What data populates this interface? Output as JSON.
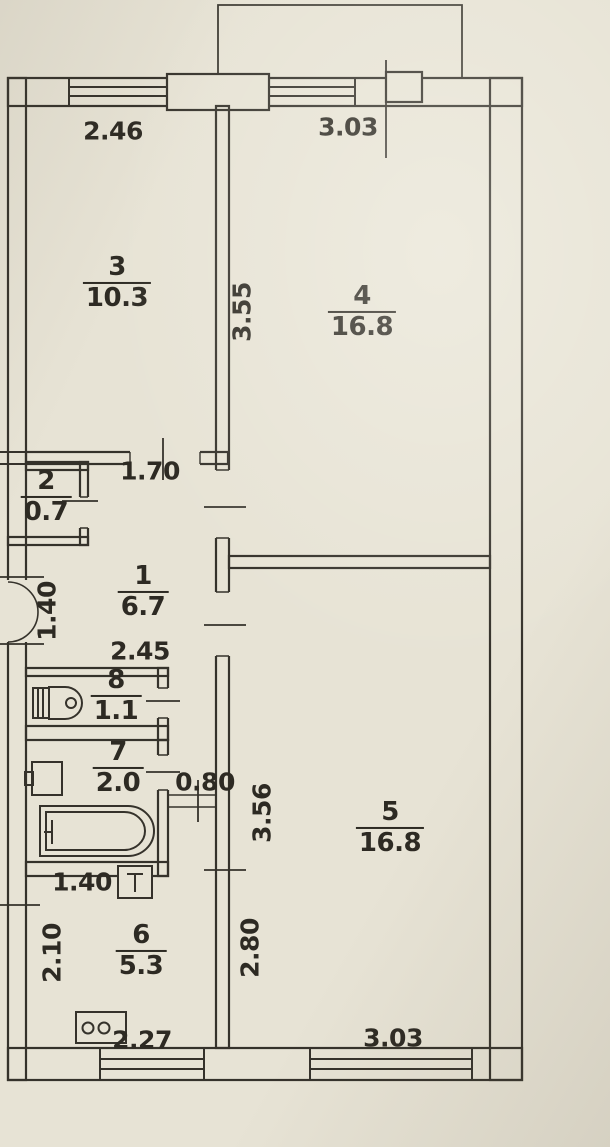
{
  "plan": {
    "title": "apartment-floor-plan",
    "colors": {
      "line": "#35322b",
      "paper": "#e7e3d5",
      "text": "#2d2a23"
    },
    "rooms": [
      {
        "id": "room-3",
        "number": "3",
        "area": "10.3"
      },
      {
        "id": "room-4",
        "number": "4",
        "area": "16.8"
      },
      {
        "id": "room-2",
        "number": "2",
        "area": "0.7"
      },
      {
        "id": "room-1",
        "number": "1",
        "area": "6.7"
      },
      {
        "id": "room-8",
        "number": "8",
        "area": "1.1"
      },
      {
        "id": "room-7",
        "number": "7",
        "area": "2.0"
      },
      {
        "id": "room-6",
        "number": "6",
        "area": "5.3"
      },
      {
        "id": "room-5",
        "number": "5",
        "area": "16.8"
      }
    ],
    "dimensions": [
      {
        "id": "room3-width-top",
        "value": "2.46",
        "orientation": "horizontal"
      },
      {
        "id": "room4-width-top",
        "value": "3.03",
        "orientation": "horizontal"
      },
      {
        "id": "room4-height-left",
        "value": "3.55",
        "orientation": "vertical"
      },
      {
        "id": "room3-door-width",
        "value": "1.70",
        "orientation": "horizontal"
      },
      {
        "id": "entrance-width",
        "value": "1.40",
        "orientation": "vertical"
      },
      {
        "id": "hall-width",
        "value": "2.45",
        "orientation": "horizontal"
      },
      {
        "id": "kitchen-door-width",
        "value": "0.80",
        "orientation": "horizontal"
      },
      {
        "id": "room5-height-upper",
        "value": "3.56",
        "orientation": "vertical"
      },
      {
        "id": "kitchen-top-width",
        "value": "1.40",
        "orientation": "horizontal"
      },
      {
        "id": "kitchen-height-left",
        "value": "2.10",
        "orientation": "vertical"
      },
      {
        "id": "kitchen-height-right",
        "value": "2.80",
        "orientation": "vertical"
      },
      {
        "id": "kitchen-width-bottom",
        "value": "2.27",
        "orientation": "horizontal"
      },
      {
        "id": "room5-width-bottom",
        "value": "3.03",
        "orientation": "horizontal"
      }
    ],
    "fixtures": [
      "toilet-icon",
      "bath-sink-icon",
      "bathtub-icon",
      "kitchen-sink-icon",
      "stove-icon",
      "entrance-door-arc"
    ],
    "windows": [
      "room3-window",
      "room4-window",
      "kitchen-window",
      "room5-window"
    ]
  }
}
